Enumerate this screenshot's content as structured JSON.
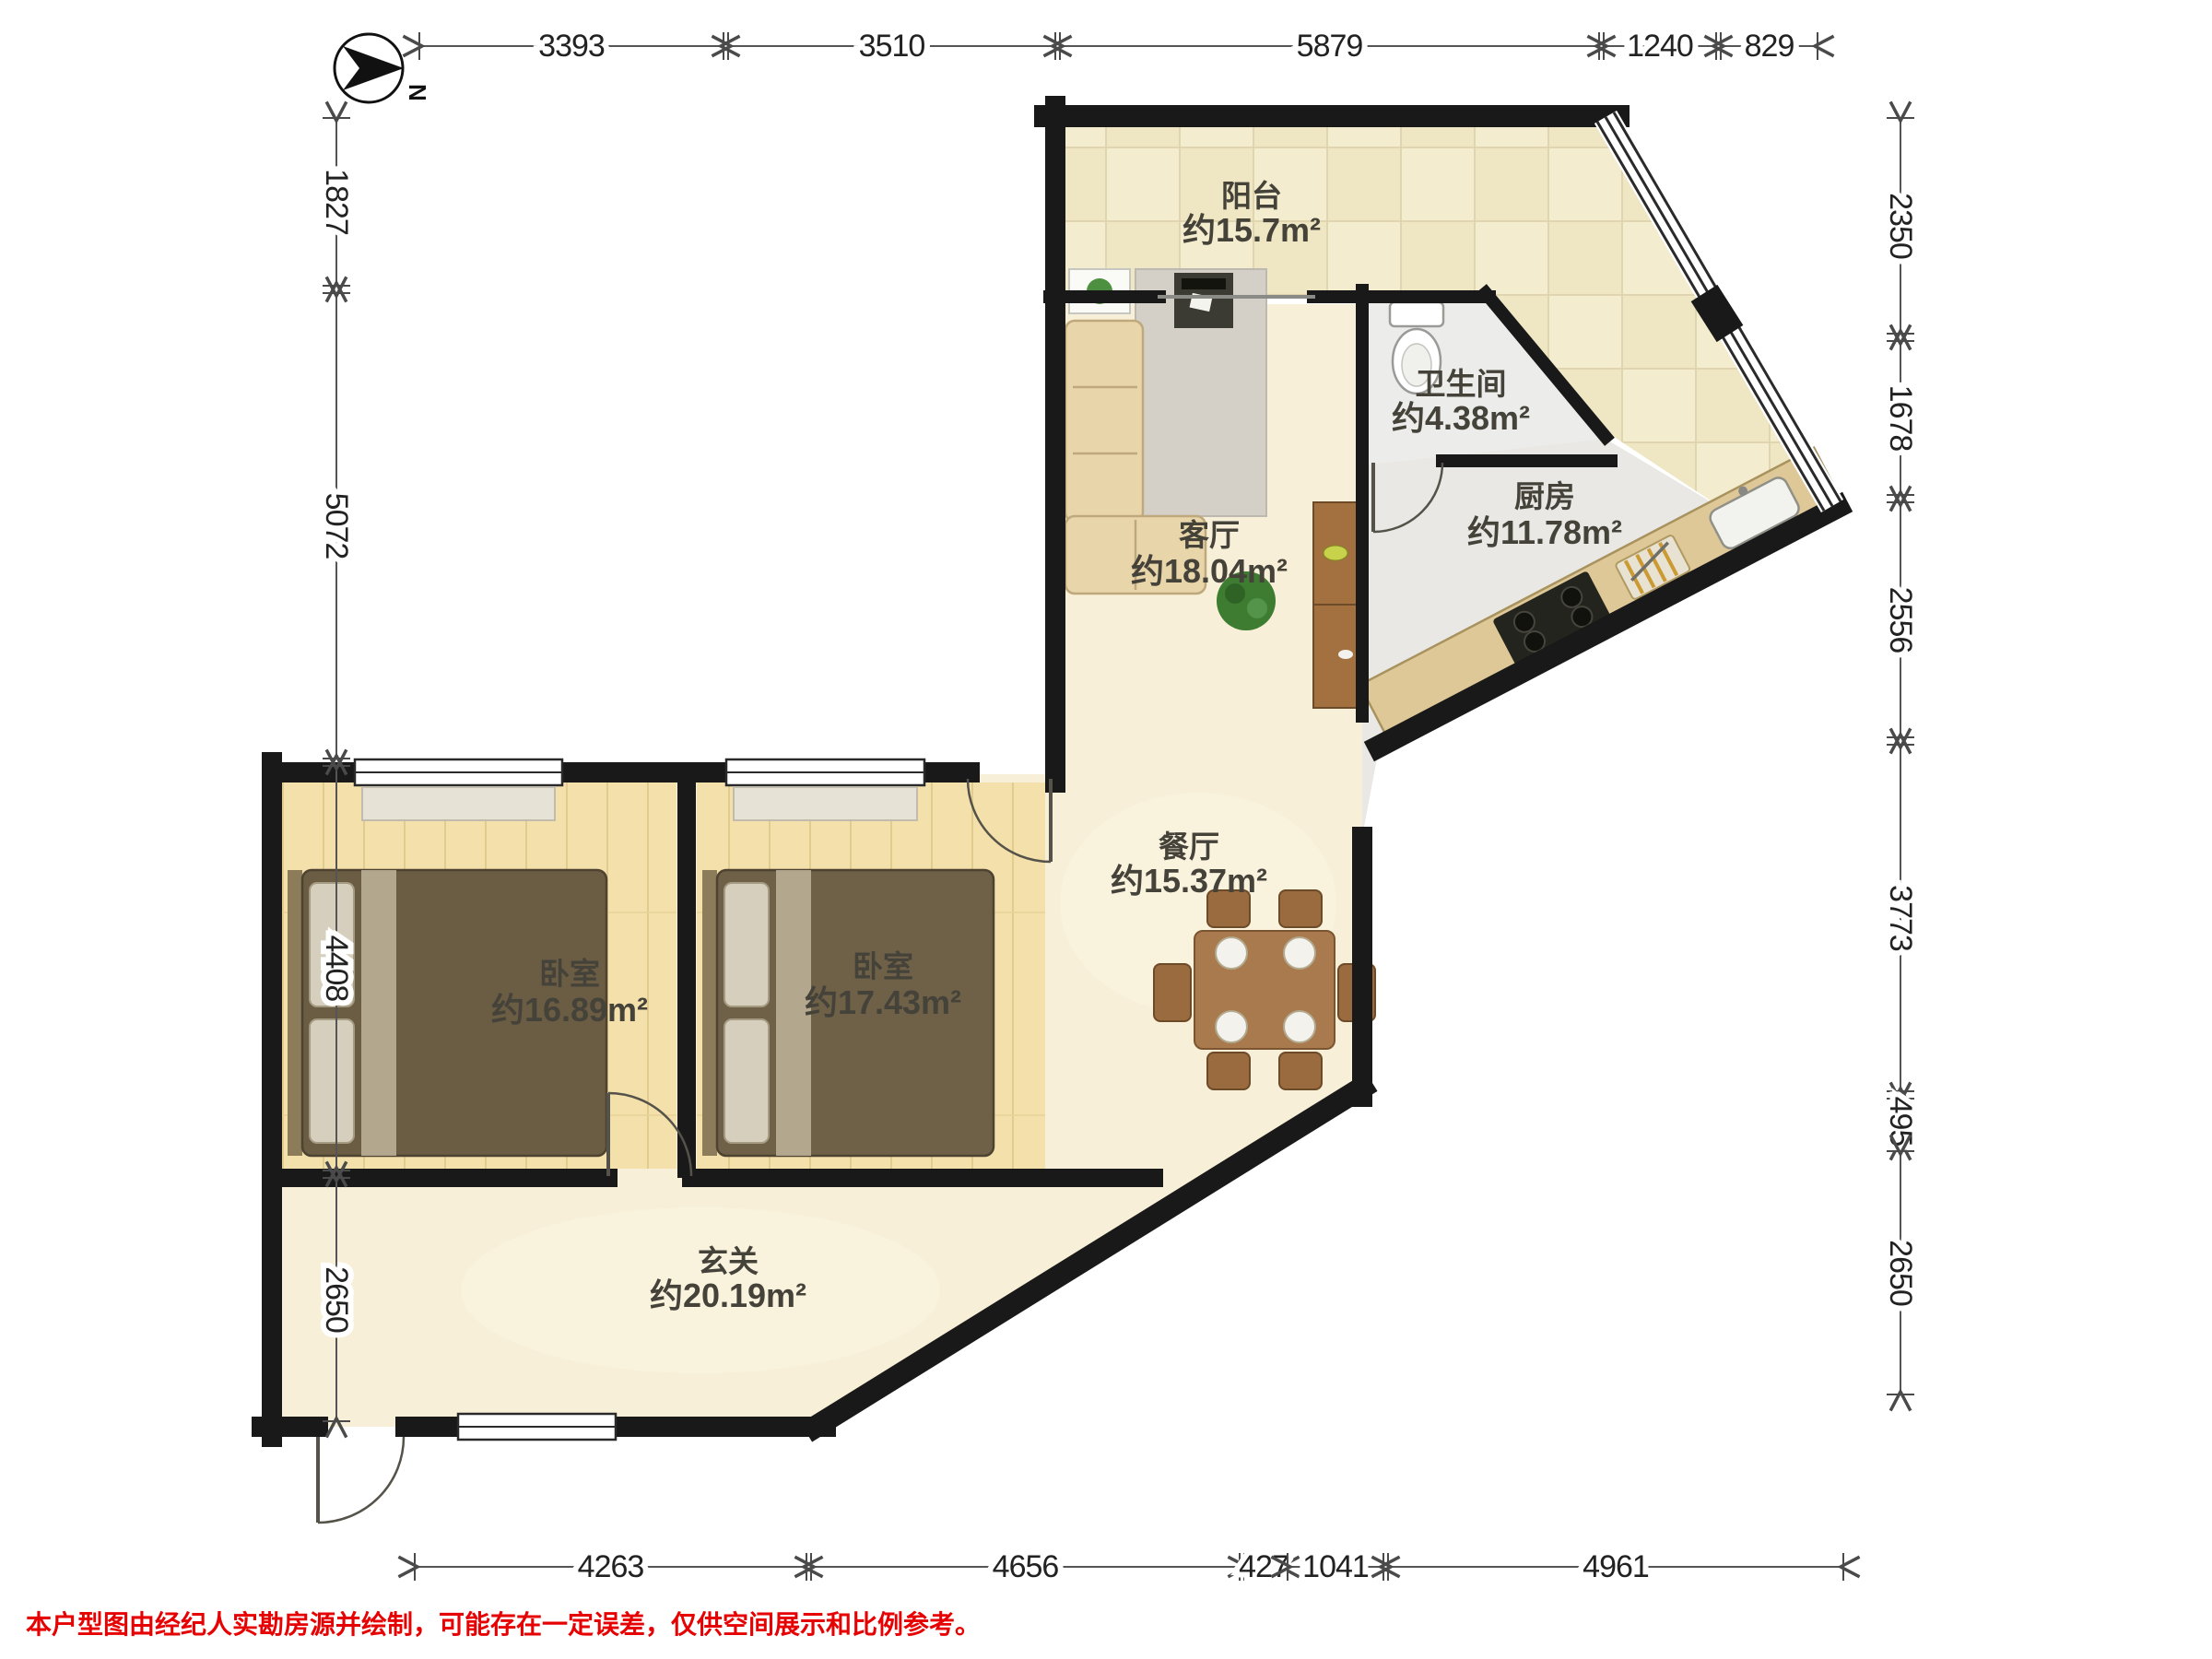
{
  "compass": {
    "label": "N"
  },
  "rooms": [
    {
      "id": "balcony",
      "name": "阳台",
      "area": "约15.7m²"
    },
    {
      "id": "bathroom",
      "name": "卫生间",
      "area": "约4.38m²"
    },
    {
      "id": "kitchen",
      "name": "厨房",
      "area": "约11.78m²"
    },
    {
      "id": "living-room",
      "name": "客厅",
      "area": "约18.04m²"
    },
    {
      "id": "dining-room",
      "name": "餐厅",
      "area": "约15.37m²"
    },
    {
      "id": "bedroom-left",
      "name": "卧室",
      "area": "约16.89m²"
    },
    {
      "id": "bedroom-right",
      "name": "卧室",
      "area": "约17.43m²"
    },
    {
      "id": "hallway",
      "name": "玄关",
      "area": "约20.19m²"
    }
  ],
  "dimensions": {
    "top": [
      "3393",
      "3510",
      "5879",
      "1240",
      "829"
    ],
    "left": [
      "1827",
      "5072",
      "4408",
      "2650"
    ],
    "right": [
      "2350",
      "1678",
      "2556",
      "3773",
      "495",
      "2650"
    ],
    "bottom": [
      "4263",
      "4656",
      "427",
      "1041",
      "4961"
    ]
  },
  "disclaimer": "本户型图由经纪人实勘房源并绘制，可能存在一定误差，仅供空间展示和比例参考。",
  "colors": {
    "wall": "#191919",
    "marble_floor": "#f7efd7",
    "tile_floor": "#f2ebcd",
    "wet_floor": "#ececea",
    "wood_floor": "#f3e0ab",
    "furniture_wood": "#a87a4e",
    "disclaimer_red": "#e60202"
  }
}
